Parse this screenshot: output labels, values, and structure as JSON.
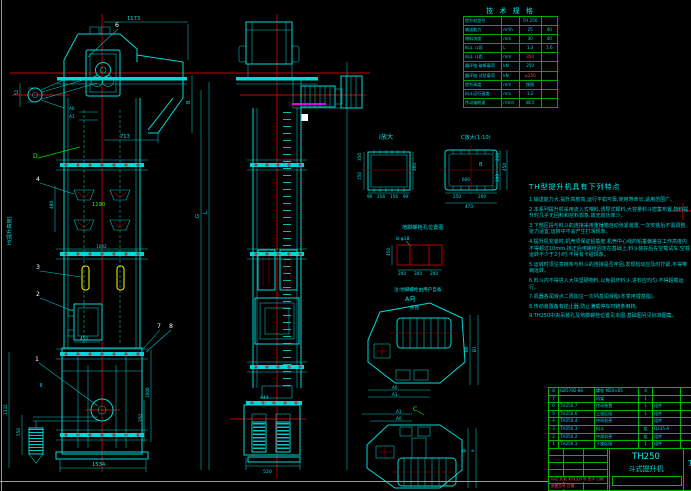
{
  "tech_table": {
    "title": "技 术 规 格",
    "rows": [
      {
        "label": "提升机型号",
        "unit": "",
        "v1": "TH 250",
        "v2": ""
      },
      {
        "label": "输送能力",
        "unit": "m³/h",
        "v1": "25",
        "v2": "40"
      },
      {
        "label": "物料块度",
        "unit": "mm",
        "v1": "30",
        "v2": "40"
      },
      {
        "label": "料斗 斗容",
        "unit": "L",
        "v1": "1.3",
        "v2": "1.6"
      },
      {
        "label": "料斗 斗距",
        "unit": "mm",
        "v1": "350",
        "v2": ""
      },
      {
        "label": "圆环链 破断载荷",
        "unit": "kN",
        "v1": "250",
        "v2": ""
      },
      {
        "label": "圆环链 试验载荷",
        "unit": "kN",
        "v1": "≥250",
        "v2": ""
      },
      {
        "label": "提升高度",
        "unit": "mm",
        "v1": "按图",
        "v2": ""
      },
      {
        "label": "料斗运行速度",
        "unit": "m/s",
        "v1": "1.2",
        "v2": ""
      },
      {
        "label": "传动轴转速",
        "unit": "r/min",
        "v1": "48.5",
        "v2": ""
      }
    ]
  },
  "notes": {
    "heading": "TH型提升机具有下列特点",
    "lines": [
      "1.输送能力大,提升高度高,运行平稳可靠,使用寿命长,适用范围广。",
      "2.本系列提升机采用流入式喂料,诱导式卸料,大容量料斗密集布置,物料提升时几乎无回料和挖料现象,故无效功率少。",
      "3.下部区段与料斗的连接采用重锤箱自动张紧装置,一次安装后不需调整,张力适宜,运转中不会产生打滑现象。",
      "4.提升机安装时,机壳须保证铅垂度,机壳中心线的铅垂偏差在工作高度内不得超过10mm,找正后用螺栓固定在基础上,料斗装好后先空载试车,空载运转不少于2小时,不得有卡碰现象。",
      "5.运转时须注意链条与料斗的连接是否牢固,发现松动应及时拧紧,不得带病运转。",
      "6.料斗内不得进入大块坚硬物料,以免损坏料斗,进料应均匀,不得超载运行。",
      "7.机器各润滑点二周加注一次钙基润滑脂(冬季用锂基脂)。",
      "8.传动装置备有逆止器,防止满载停车时链条倒转。",
      "9.TH250中央吊装孔及地脚螺栓位置见本图,基础图另见标准图集。"
    ]
  },
  "bom": {
    "rows": [
      {
        "no": "8",
        "code": "GB5782-86",
        "name": "螺栓 M20×65",
        "qty": "4",
        "mat": "",
        "w": ""
      },
      {
        "no": "7",
        "code": "",
        "name": "机架",
        "qty": "1",
        "mat": "",
        "w": ""
      },
      {
        "no": "6",
        "code": "TH250.7",
        "name": "传动装置",
        "qty": "1",
        "mat": "组件",
        "w": ""
      },
      {
        "no": "5",
        "code": "TH250.6",
        "name": "上部区段",
        "qty": "1",
        "mat": "组件",
        "w": ""
      },
      {
        "no": "4",
        "code": "TH250.4",
        "name": "中间机壳",
        "qty": "",
        "mat": "组件",
        "w": ""
      },
      {
        "no": "3",
        "code": "TH250.3",
        "name": "料斗",
        "qty": "组",
        "mat": "Q235-A",
        "w": ""
      },
      {
        "no": "2",
        "code": "TH250.2",
        "name": "中部机壳",
        "qty": "组",
        "mat": "组件",
        "w": ""
      },
      {
        "no": "1",
        "code": "TH250.1",
        "name": "下部区段",
        "qty": "1",
        "mat": "组件",
        "w": ""
      }
    ],
    "header": {
      "no": "件",
      "code": "代号",
      "name": "名称",
      "qty": "数量",
      "mat": "材料",
      "w": "单件 总计"
    }
  },
  "title_block": {
    "model": "TH250",
    "name": "斗式提升机",
    "drawing_no": "TH2",
    "rev_row": "标记 处数 更改文件号 签字 日期",
    "archive_row": "底图总号  日期"
  },
  "front": {
    "d1173": "1173",
    "d713": "713",
    "dB": "B",
    "a0": "A0",
    "a1": "A1",
    "d52": "52",
    "d480": "480",
    "d1190": "1190",
    "d1002": "1002",
    "d450": "450",
    "d1332": "1332",
    "d550": "550",
    "d1000": "1000",
    "d350": "350",
    "d1534": "1534",
    "g": "G",
    "l": "L",
    "d_label": "D",
    "sec2": "Ⅱ",
    "h_note": "H(提升高度)",
    "p1": "1",
    "p2": "2",
    "p3": "3",
    "p4": "4",
    "p6": "6",
    "p7": "7",
    "p8": "8"
  },
  "side": {
    "d444": "444",
    "d520": "520"
  },
  "secI": {
    "label": "Ⅰ放大",
    "d360": "360",
    "d350": "350",
    "d150": "150",
    "b1": "90",
    "b2": "156",
    "b3": "156",
    "b4": "90"
  },
  "secC": {
    "label": "C放大(1:10)",
    "d600": "600",
    "dB": "B",
    "d250b": "250",
    "d200b": "200",
    "d470": "470",
    "d250r": "250",
    "d200r": "200",
    "d450": "450"
  },
  "foundation": {
    "caption": "地脚螺栓孔位置图",
    "holes": "8-φ18",
    "d450": "450",
    "d200a": "200",
    "d300": "300",
    "d200b": "200",
    "note": "注:地脚螺栓由用户自备",
    "a_label": "A向",
    "sub": "俯视"
  },
  "topview": {
    "a0": "A0",
    "a1": "A1",
    "b0": "B0",
    "b1": "B1"
  },
  "bottomview": {
    "c_label": "C",
    "a1": "A1",
    "a0": "A0",
    "b": "B",
    "a": "a"
  }
}
